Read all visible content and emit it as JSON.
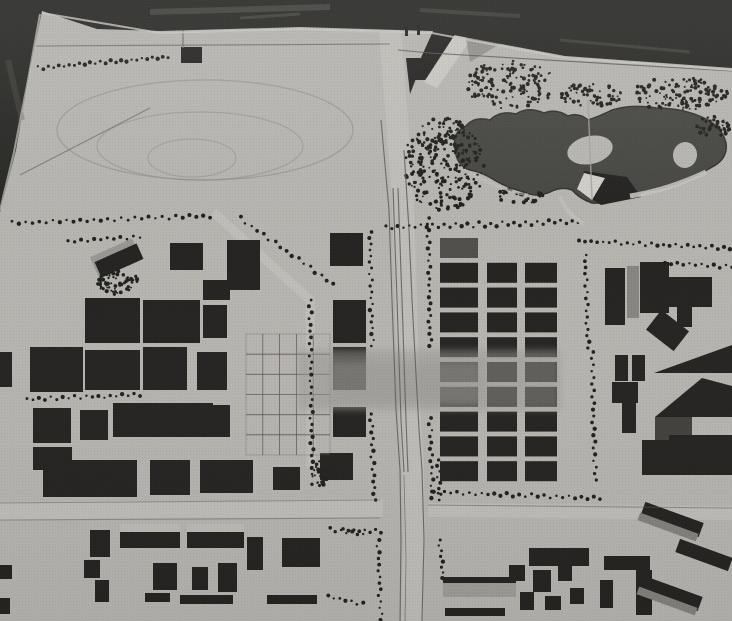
{
  "meta": {
    "alt": "Black-and-white aerial photograph of an architectural town-planning scale model: racetrack oval at upper left, tree-ringed pond with two islands at upper right, a central north-south road lined with trees, dense grids of dark building blocks on both sides, and rows of low slab buildings along the bottom",
    "width": 732,
    "height": 621
  },
  "scene": {
    "palette": {
      "paper": "#c9c7c2",
      "ink": "#232220",
      "block_gray": "#55544f",
      "tree": "#1e1e1c",
      "pond": "#4a4a46",
      "pond_edge": "#34342f",
      "backdrop": "#272724",
      "streak": "#5b5b55",
      "road_light": "#d3d1cc",
      "edge_line": "#63625c",
      "ghost": "#a9a7a2",
      "light_face": "#d8d6d1",
      "wire": "#4a4946"
    },
    "backdrop": {
      "poly": "0,0 732,0 732,68 565,56 432,31 300,27 160,31 97,29 42,11 30,70 16,150 0,212",
      "edge_highlight": "42,13 160,33 300,29 432,33 565,58 732,70",
      "edge_highlight2": "40,14 28,80 14,152 0,210",
      "streaks": [
        {
          "d": "M150,12 L330,7",
          "w": 6,
          "o": 0.55
        },
        {
          "d": "M420,10 L520,16",
          "w": 4,
          "o": 0.45
        },
        {
          "d": "M560,40 L690,52",
          "w": 3,
          "o": 0.45
        },
        {
          "d": "M8,60 L22,120",
          "w": 6,
          "o": 0.35
        },
        {
          "d": "M240,18 L300,14",
          "w": 3,
          "o": 0.5
        }
      ]
    },
    "track": [
      {
        "cx": 205,
        "cy": 130,
        "rx": 148,
        "ry": 50,
        "o": 0.55
      },
      {
        "cx": 200,
        "cy": 146,
        "rx": 103,
        "ry": 34,
        "o": 0.45
      },
      {
        "cx": 192,
        "cy": 158,
        "rx": 44,
        "ry": 19,
        "o": 0.45
      }
    ],
    "roads": [
      {
        "d": "M390,30 L397,120 L403,200 L406,300 L409,400 L413,470 L414,540 L412,621",
        "w": 22
      },
      {
        "d": "M0,511 L383,508",
        "w": 18
      },
      {
        "d": "M428,510 L732,513",
        "w": 14
      },
      {
        "d": "M213,212 L310,300 L311,468",
        "w": 9
      },
      {
        "d": "M575,0 L577,32",
        "w": 8
      }
    ],
    "road_edges": [
      {
        "d": "M381,120 L389,210 L392,300 L396,410 L400,470 L401,540 L400,621"
      },
      {
        "d": "M404,150 L409,230 L412,300 L419,430 L422,470 L424,540 L422,621"
      },
      {
        "d": "M393,188 L397,300 L401,420 L404,472"
      },
      {
        "d": "M398,188 L402,300 L406,420 L408,472"
      },
      {
        "d": "M404,475 L406,560 L405,621",
        "w": 0.8,
        "o": 0.7
      },
      {
        "d": "M36,46 L390,44",
        "o": 0.7
      },
      {
        "d": "M398,50 L430,53 L732,71"
      },
      {
        "d": "M0,503 L380,500",
        "o": 0.5
      },
      {
        "d": "M0,520 L380,518",
        "o": 0.5
      },
      {
        "d": "M428,505 L732,508",
        "o": 0.5
      },
      {
        "d": "M20,175 L150,108",
        "o": 0.6
      },
      {
        "d": "M183,10 L183,48",
        "c": "#7f7d77",
        "w": 1.6,
        "o": 0.8
      },
      {
        "d": "M588,100 L592,200",
        "c": "#b4b2ac",
        "w": 1.4,
        "o": 0.85
      },
      {
        "d": "M630,196 Q668,190 706,172",
        "c": "#d8d6d1",
        "w": 5,
        "o": 0.9
      },
      {
        "d": "M470,173 Q500,190 528,195",
        "c": "#d5d3ce",
        "w": 3,
        "o": 0.6
      },
      {
        "d": "M560,196 Q566,214 584,224",
        "c": "#d5d3ce",
        "w": 4,
        "o": 0.8
      }
    ],
    "pond": {
      "path": "M455,148 Q452,132 466,126 Q474,116 490,120 Q500,110 516,114 Q528,106 544,113 Q556,108 568,116 Q578,112 588,120 Q600,116 612,110 Q632,104 656,108 Q684,108 706,119 Q722,127 726,143 Q728,158 714,166 Q700,174 684,181 Q664,189 646,191 Q630,196 616,199 Q604,204 592,203 Q580,199 572,190 Q562,186 550,192 Q536,198 524,192 Q508,188 496,181 Q482,172 470,170 Q456,166 455,148 Z",
      "islands": [
        {
          "cx": 590,
          "cy": 150,
          "rx": 23,
          "ry": 14,
          "rot": -12
        },
        {
          "cx": 685,
          "cy": 155,
          "rx": 12,
          "ry": 13,
          "rot": 8
        }
      ],
      "wedge_dark": "584,171 627,177 641,197 601,205 579,191",
      "wedge_light": "584,173 605,178 592,200 577,189"
    },
    "wireframe": {
      "x": 246,
      "y": 334,
      "w": 84,
      "h": 121,
      "cols": 5,
      "rows": 6
    },
    "ghost": [
      {
        "x": 298,
        "y": 350,
        "w": 262,
        "h": 60,
        "o": 0.5
      },
      {
        "x": 330,
        "y": 362,
        "w": 150,
        "h": 42,
        "o": 0.4
      }
    ],
    "superblock": {
      "y": 238,
      "pitch": 24.8,
      "h": 20,
      "rows": 10,
      "cols": [
        {
          "x": 440,
          "w": 38
        },
        {
          "x": 487,
          "w": 30
        },
        {
          "x": 525,
          "w": 32
        }
      ]
    },
    "polys": [
      {
        "pts": "438,20 463,20 429,80 411,80"
      },
      {
        "pts": "463,22 479,28 437,88 424,82",
        "c": "#dedcd7"
      },
      {
        "pts": "406,58 424,58 410,94"
      },
      {
        "pts": "465,32 500,44 470,62",
        "c": "#8b8a84",
        "o": 0.65
      },
      {
        "pts": "654,373 732,345 732,373"
      },
      {
        "pts": "655,417 702,378 732,386 732,417"
      }
    ],
    "buildings": [
      {
        "x": 181,
        "y": 47,
        "w": 21,
        "h": 16
      },
      {
        "x": 92,
        "y": 247,
        "w": 46,
        "h": 20,
        "rot": -24,
        "c": "#a8a6a0"
      },
      {
        "x": 96,
        "y": 252,
        "w": 46,
        "h": 17,
        "rot": -24
      },
      {
        "x": 170,
        "y": 243,
        "w": 33,
        "h": 27
      },
      {
        "x": 227,
        "y": 240,
        "w": 33,
        "h": 50
      },
      {
        "x": 85,
        "y": 298,
        "w": 55,
        "h": 45
      },
      {
        "x": 143,
        "y": 300,
        "w": 57,
        "h": 43
      },
      {
        "x": 203,
        "y": 280,
        "w": 27,
        "h": 20
      },
      {
        "x": 203,
        "y": 305,
        "w": 24,
        "h": 33
      },
      {
        "x": 0,
        "y": 352,
        "w": 12,
        "h": 35
      },
      {
        "x": 30,
        "y": 347,
        "w": 53,
        "h": 45
      },
      {
        "x": 85,
        "y": 350,
        "w": 55,
        "h": 40
      },
      {
        "x": 143,
        "y": 347,
        "w": 44,
        "h": 43
      },
      {
        "x": 197,
        "y": 352,
        "w": 30,
        "h": 38
      },
      {
        "x": 33,
        "y": 408,
        "w": 38,
        "h": 35
      },
      {
        "x": 80,
        "y": 410,
        "w": 28,
        "h": 30
      },
      {
        "x": 113,
        "y": 403,
        "w": 100,
        "h": 34
      },
      {
        "x": 33,
        "y": 447,
        "w": 39,
        "h": 23
      },
      {
        "x": 203,
        "y": 405,
        "w": 27,
        "h": 32
      },
      {
        "x": 43,
        "y": 460,
        "w": 94,
        "h": 37
      },
      {
        "x": 150,
        "y": 460,
        "w": 40,
        "h": 35
      },
      {
        "x": 200,
        "y": 460,
        "w": 53,
        "h": 33
      },
      {
        "x": 273,
        "y": 467,
        "w": 27,
        "h": 23
      },
      {
        "x": 330,
        "y": 233,
        "w": 33,
        "h": 33
      },
      {
        "x": 333,
        "y": 300,
        "w": 33,
        "h": 43
      },
      {
        "x": 333,
        "y": 347,
        "w": 33,
        "h": 43
      },
      {
        "x": 333,
        "y": 407,
        "w": 33,
        "h": 30
      },
      {
        "x": 320,
        "y": 453,
        "w": 33,
        "h": 27
      },
      {
        "x": 84,
        "y": 560,
        "w": 16,
        "h": 18
      },
      {
        "x": 95,
        "y": 580,
        "w": 14,
        "h": 22
      },
      {
        "x": 90,
        "y": 530,
        "w": 20,
        "h": 27
      },
      {
        "x": 120,
        "y": 524,
        "w": 60,
        "h": 10,
        "c": "#d0cec9"
      },
      {
        "x": 120,
        "y": 532,
        "w": 60,
        "h": 16
      },
      {
        "x": 187,
        "y": 524,
        "w": 57,
        "h": 10,
        "c": "#d0cec9"
      },
      {
        "x": 187,
        "y": 532,
        "w": 57,
        "h": 16
      },
      {
        "x": 247,
        "y": 537,
        "w": 16,
        "h": 33
      },
      {
        "x": 282,
        "y": 538,
        "w": 38,
        "h": 29
      },
      {
        "x": 153,
        "y": 563,
        "w": 24,
        "h": 27
      },
      {
        "x": 192,
        "y": 567,
        "w": 16,
        "h": 23
      },
      {
        "x": 218,
        "y": 563,
        "w": 19,
        "h": 29
      },
      {
        "x": 145,
        "y": 593,
        "w": 25,
        "h": 9
      },
      {
        "x": 180,
        "y": 595,
        "w": 53,
        "h": 9
      },
      {
        "x": 267,
        "y": 595,
        "w": 50,
        "h": 9
      },
      {
        "x": 0,
        "y": 565,
        "w": 12,
        "h": 14
      },
      {
        "x": 0,
        "y": 598,
        "w": 10,
        "h": 16
      },
      {
        "x": 605,
        "y": 268,
        "w": 20,
        "h": 57
      },
      {
        "x": 627,
        "y": 266,
        "w": 12,
        "h": 52,
        "c": "#93918c"
      },
      {
        "x": 640,
        "y": 262,
        "w": 29,
        "h": 51
      },
      {
        "x": 669,
        "y": 277,
        "w": 43,
        "h": 30
      },
      {
        "x": 677,
        "y": 307,
        "w": 15,
        "h": 20
      },
      {
        "x": 650,
        "y": 318,
        "w": 35,
        "h": 25,
        "rot": 38
      },
      {
        "x": 615,
        "y": 355,
        "w": 13,
        "h": 26
      },
      {
        "x": 632,
        "y": 355,
        "w": 13,
        "h": 26
      },
      {
        "x": 612,
        "y": 382,
        "w": 26,
        "h": 21
      },
      {
        "x": 622,
        "y": 393,
        "w": 14,
        "h": 40
      },
      {
        "x": 655,
        "y": 417,
        "w": 37,
        "h": 26,
        "c": "#45443f"
      },
      {
        "x": 642,
        "y": 440,
        "w": 27,
        "h": 23
      },
      {
        "x": 669,
        "y": 435,
        "w": 63,
        "h": 28
      },
      {
        "x": 642,
        "y": 463,
        "w": 90,
        "h": 12
      },
      {
        "x": 443,
        "y": 581,
        "w": 73,
        "h": 16,
        "c": "#aeaca6"
      },
      {
        "x": 443,
        "y": 577,
        "w": 73,
        "h": 6
      },
      {
        "x": 445,
        "y": 608,
        "w": 60,
        "h": 8
      },
      {
        "x": 529,
        "y": 548,
        "w": 60,
        "h": 18
      },
      {
        "x": 509,
        "y": 565,
        "w": 16,
        "h": 16
      },
      {
        "x": 533,
        "y": 570,
        "w": 18,
        "h": 22
      },
      {
        "x": 558,
        "y": 563,
        "w": 14,
        "h": 18
      },
      {
        "x": 520,
        "y": 592,
        "w": 14,
        "h": 18
      },
      {
        "x": 545,
        "y": 596,
        "w": 16,
        "h": 14
      },
      {
        "x": 570,
        "y": 588,
        "w": 14,
        "h": 16
      },
      {
        "x": 604,
        "y": 556,
        "w": 46,
        "h": 14
      },
      {
        "x": 636,
        "y": 570,
        "w": 16,
        "h": 45
      },
      {
        "x": 600,
        "y": 580,
        "w": 13,
        "h": 28
      },
      {
        "x": 641,
        "y": 512,
        "w": 62,
        "h": 15,
        "rot": 20
      },
      {
        "x": 637,
        "y": 523,
        "w": 62,
        "h": 8,
        "rot": 20,
        "c": "#8f8d88"
      },
      {
        "x": 676,
        "y": 548,
        "w": 56,
        "h": 14,
        "rot": 20
      },
      {
        "x": 640,
        "y": 586,
        "w": 62,
        "h": 15,
        "rot": 20
      },
      {
        "x": 636,
        "y": 597,
        "w": 62,
        "h": 8,
        "rot": 20,
        "c": "#8f8d88"
      }
    ],
    "tree_rows": [
      {
        "x1": 38,
        "y1": 68,
        "x2": 168,
        "y2": 57,
        "n": 26
      },
      {
        "x1": 12,
        "y1": 223,
        "x2": 210,
        "y2": 216,
        "n": 30
      },
      {
        "x1": 240,
        "y1": 218,
        "x2": 333,
        "y2": 284,
        "n": 17
      },
      {
        "x1": 68,
        "y1": 241,
        "x2": 140,
        "y2": 237,
        "n": 12
      },
      {
        "x1": 27,
        "y1": 399,
        "x2": 140,
        "y2": 395,
        "n": 20
      },
      {
        "x1": 310,
        "y1": 300,
        "x2": 312,
        "y2": 468,
        "n": 28
      },
      {
        "x1": 370,
        "y1": 232,
        "x2": 372,
        "y2": 346,
        "n": 20
      },
      {
        "x1": 371,
        "y1": 414,
        "x2": 374,
        "y2": 500,
        "n": 15
      },
      {
        "x1": 378,
        "y1": 540,
        "x2": 381,
        "y2": 620,
        "n": 14
      },
      {
        "x1": 428,
        "y1": 218,
        "x2": 430,
        "y2": 346,
        "n": 22
      },
      {
        "x1": 430,
        "y1": 418,
        "x2": 433,
        "y2": 498,
        "n": 14
      },
      {
        "x1": 440,
        "y1": 540,
        "x2": 443,
        "y2": 578,
        "n": 8
      },
      {
        "x1": 386,
        "y1": 228,
        "x2": 578,
        "y2": 221,
        "n": 34,
        "amp": 2.4
      },
      {
        "x1": 579,
        "y1": 241,
        "x2": 730,
        "y2": 248,
        "n": 26
      },
      {
        "x1": 665,
        "y1": 263,
        "x2": 732,
        "y2": 267,
        "n": 12
      },
      {
        "x1": 585,
        "y1": 255,
        "x2": 588,
        "y2": 348,
        "n": 16
      },
      {
        "x1": 592,
        "y1": 352,
        "x2": 595,
        "y2": 480,
        "n": 21
      },
      {
        "x1": 432,
        "y1": 492,
        "x2": 600,
        "y2": 498,
        "n": 28
      },
      {
        "x1": 330,
        "y1": 529,
        "x2": 363,
        "y2": 535,
        "n": 7
      },
      {
        "x1": 328,
        "y1": 597,
        "x2": 363,
        "y2": 604,
        "n": 7
      },
      {
        "x1": 438,
        "y1": 460,
        "x2": 440,
        "y2": 500,
        "n": 8
      },
      {
        "x1": 343,
        "y1": 530,
        "x2": 381,
        "y2": 531,
        "n": 8
      }
    ],
    "tree_clusters": [
      {
        "cx": 511,
        "cy": 85,
        "rx": 45,
        "ry": 25,
        "n": 150
      },
      {
        "cx": 444,
        "cy": 165,
        "rx": 40,
        "ry": 48,
        "n": 260
      },
      {
        "cx": 590,
        "cy": 95,
        "rx": 32,
        "ry": 12,
        "n": 55
      },
      {
        "cx": 680,
        "cy": 94,
        "rx": 48,
        "ry": 17,
        "n": 120
      },
      {
        "cx": 713,
        "cy": 127,
        "rx": 17,
        "ry": 11,
        "n": 40
      },
      {
        "cx": 520,
        "cy": 196,
        "rx": 26,
        "ry": 8,
        "n": 28
      },
      {
        "cx": 118,
        "cy": 283,
        "rx": 22,
        "ry": 12,
        "n": 60
      },
      {
        "cx": 318,
        "cy": 475,
        "rx": 10,
        "ry": 14,
        "n": 25
      }
    ],
    "marks": {
      "ticks": [
        {
          "x": 405,
          "y": 26,
          "w": 3,
          "h": 10
        },
        {
          "x": 417,
          "y": 25,
          "w": 3,
          "h": 10
        }
      ]
    }
  }
}
